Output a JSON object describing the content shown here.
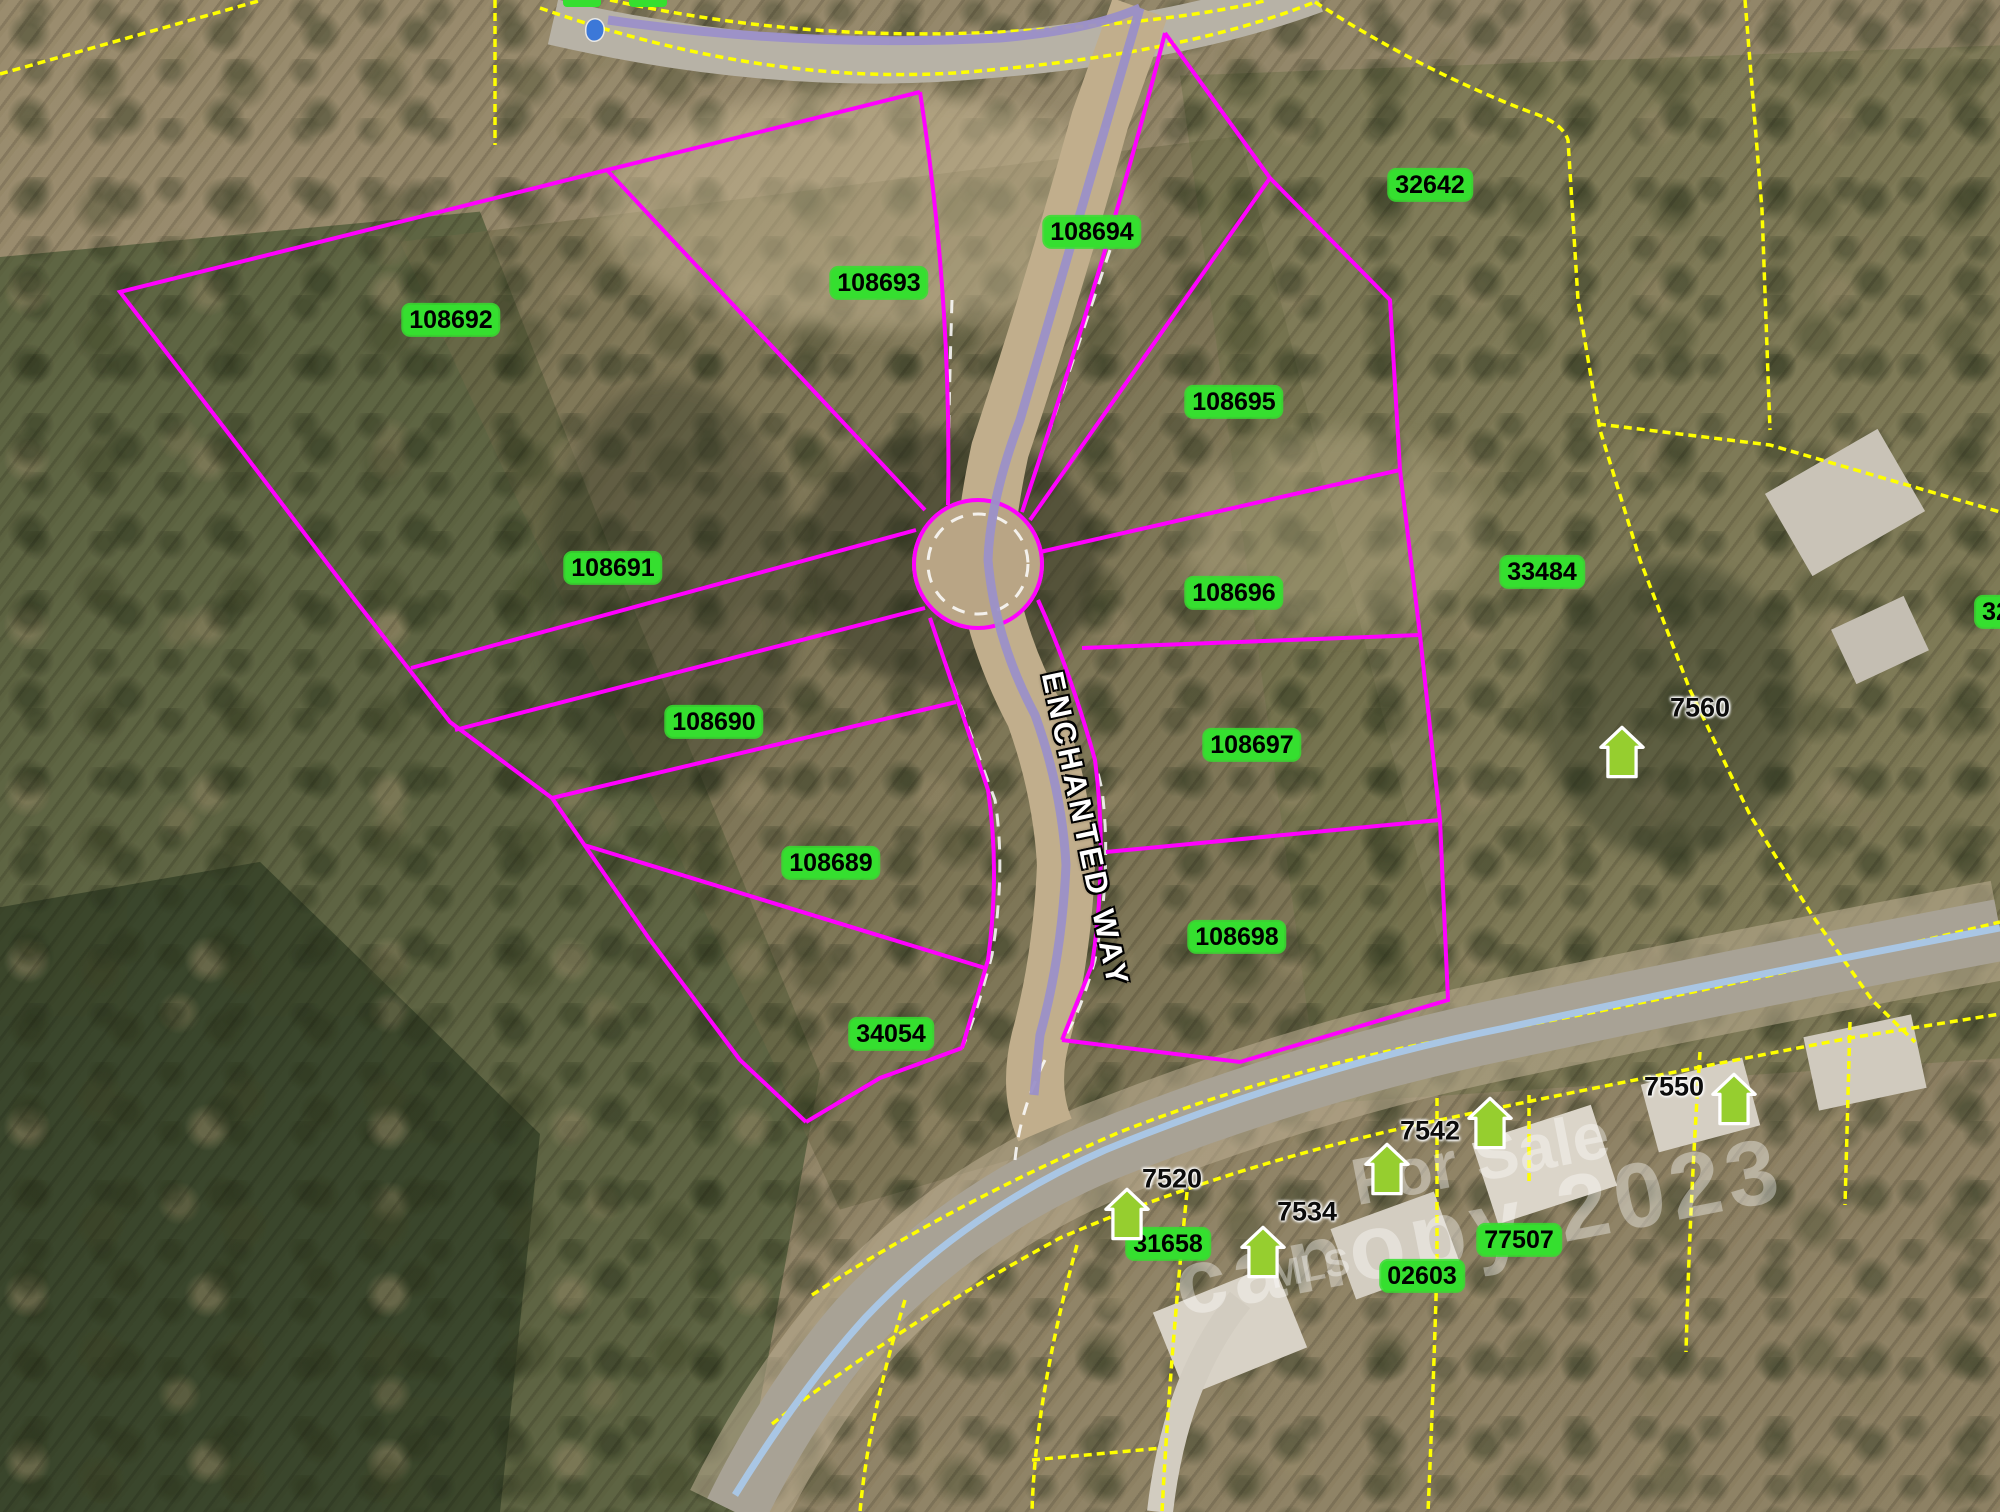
{
  "map": {
    "street_label": "ENCHANTED WAY",
    "watermark": {
      "for_sale": "For Sale",
      "canopy": "canopy 2023",
      "mls": "MLS"
    },
    "colors": {
      "subdivision_boundary": "#FF00FF",
      "parcel_boundary": "#FFFF00",
      "parcel_label_bg": "#35DF2F",
      "parcel_label_text": "#000000",
      "street_centerline": "#9B90C8",
      "highway_centerline": "#A9C6E4",
      "house_marker": "#96CE2F",
      "point_marker": "#3C78D8",
      "street_label_text": "#FFFFFF"
    },
    "parcel_labels": [
      {
        "text": "108692",
        "x": 451,
        "y": 320
      },
      {
        "text": "108693",
        "x": 879,
        "y": 283
      },
      {
        "text": "108694",
        "x": 1092,
        "y": 232
      },
      {
        "text": "108695",
        "x": 1234,
        "y": 402
      },
      {
        "text": "108691",
        "x": 613,
        "y": 568
      },
      {
        "text": "108696",
        "x": 1234,
        "y": 593
      },
      {
        "text": "108697",
        "x": 1252,
        "y": 745
      },
      {
        "text": "108690",
        "x": 714,
        "y": 722
      },
      {
        "text": "108689",
        "x": 831,
        "y": 863
      },
      {
        "text": "108698",
        "x": 1237,
        "y": 937
      },
      {
        "text": "34054",
        "x": 891,
        "y": 1034
      },
      {
        "text": "32642",
        "x": 1430,
        "y": 185
      },
      {
        "text": "33484",
        "x": 1542,
        "y": 572
      },
      {
        "text": "31658",
        "x": 1168,
        "y": 1244
      },
      {
        "text": "02603",
        "x": 1422,
        "y": 1276
      },
      {
        "text": "77507",
        "x": 1519,
        "y": 1240
      },
      {
        "text": "32",
        "x": 1996,
        "y": 612
      }
    ],
    "address_labels": [
      {
        "text": "7560",
        "x": 1700,
        "y": 708
      },
      {
        "text": "7550",
        "x": 1674,
        "y": 1087
      },
      {
        "text": "7542",
        "x": 1430,
        "y": 1131
      },
      {
        "text": "7534",
        "x": 1307,
        "y": 1212
      },
      {
        "text": "7520",
        "x": 1172,
        "y": 1179
      }
    ],
    "house_icons": [
      {
        "x": 1622,
        "y": 752
      },
      {
        "x": 1127,
        "y": 1214
      },
      {
        "x": 1263,
        "y": 1252
      },
      {
        "x": 1387,
        "y": 1169
      },
      {
        "x": 1490,
        "y": 1123
      },
      {
        "x": 1734,
        "y": 1099
      }
    ],
    "clipped_top_labels": [
      {
        "x": 582
      },
      {
        "x": 648
      }
    ],
    "point_marker": {
      "x": 595,
      "y": 30
    }
  }
}
